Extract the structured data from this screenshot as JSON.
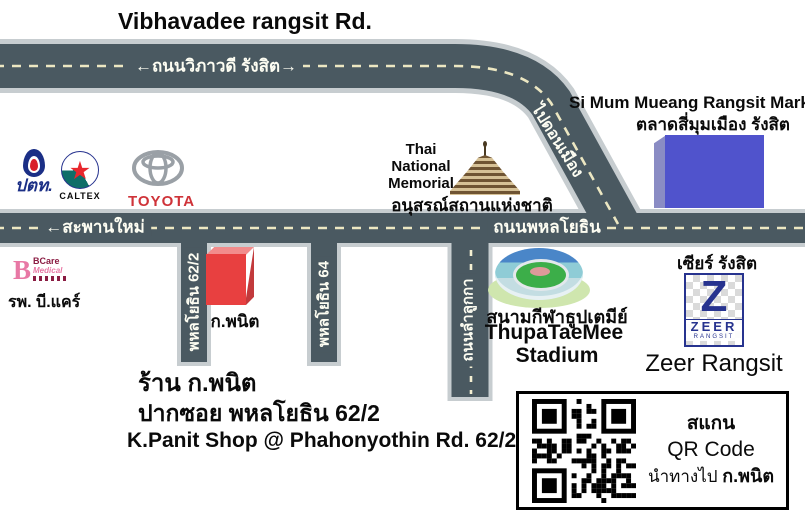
{
  "title": "Vibhavadee rangsit Rd.",
  "roads": {
    "vibhavadee": {
      "label": "←ถนนวิภาวดี รังสิต→"
    },
    "don_mueang": {
      "label": "ไปดอนเมือง"
    },
    "phahonyothin": {
      "label": "ถนนพหลโยธิน"
    },
    "saphan_mai": {
      "label": "←สะพานใหม่"
    },
    "soi_62_2": {
      "label": "พหลโยธิน 62/2"
    },
    "soi_64": {
      "label": "พหลโยธิน 64"
    },
    "lam_luk_ka": {
      "label": "ถนนลำลูกกา"
    }
  },
  "landmarks": {
    "ptt": {
      "label": "ปตท."
    },
    "caltex": {
      "label": "CALTEX",
      "star": "★"
    },
    "toyota": {
      "label": "TOYOTA"
    },
    "memorial": {
      "lines": [
        "Thai",
        "National",
        "Memorial"
      ],
      "thai": "อนุสรณ์สถานแห่งชาติ"
    },
    "market": {
      "en": "Si Mum Mueang Rangsit Market",
      "thai": "ตลาดสี่มุมเมือง รังสิต"
    },
    "bcare": {
      "thai": "รพ. บี.แคร์",
      "logo_b": "B",
      "logo_name": "BCare",
      "logo_sub": "Medical"
    },
    "kpanit_building": {
      "label": "ก.พนิต"
    },
    "stadium": {
      "thai": "สนามกีฬาธูปเตมีย์",
      "en1": "ThupaTaeMee",
      "en2": "Stadium"
    },
    "zeer": {
      "thai": "เซียร์ รังสิต",
      "logo_z": "Z",
      "logo_name": "ZEER",
      "logo_sub": "RANGSIT",
      "en": "Zeer Rangsit"
    }
  },
  "shop_info": {
    "line1": "ร้าน ก.พนิต",
    "line2": "ปากซอย พหลโยธิน 62/2",
    "line3": "K.Panit Shop @ Phahonyothin Rd. 62/2"
  },
  "qr": {
    "line1": "สแกน",
    "line2": "QR Code",
    "line3_prefix": "นำทางไป ",
    "line3_bold": "ก.พนิต"
  },
  "colors": {
    "road": "#4a5961",
    "road_shoulder": "#c7cdd0",
    "road_dash": "#ece7c2",
    "market_blue": "#5053cc",
    "shop_red": "#e84040",
    "zeer_blue": "#27338f",
    "toyota_red": "#cf3339",
    "caltex_teal": "#0e6e68",
    "caltex_red": "#e8272d",
    "ptt_blue": "#1b2f86",
    "bcare_pink": "#e878a5"
  }
}
